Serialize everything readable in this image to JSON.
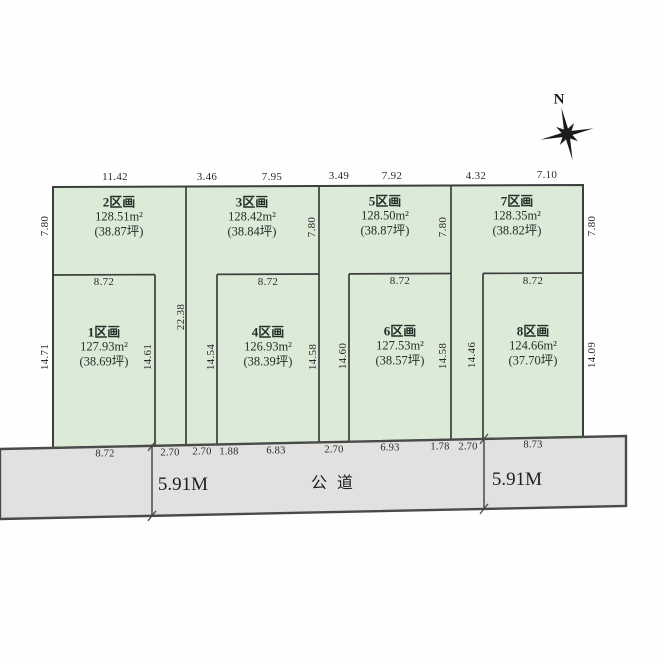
{
  "compass": {
    "north_label": "N"
  },
  "top_dims": [
    "11.42",
    "3.46",
    "7.95",
    "3.49",
    "7.92",
    "4.32",
    "7.10"
  ],
  "parcels": {
    "p1": {
      "name": "1区画",
      "area": "127.93m²",
      "tsubo": "(38.69坪)",
      "width": "8.72"
    },
    "p2": {
      "name": "2区画",
      "area": "128.51m²",
      "tsubo": "(38.87坪)"
    },
    "p3": {
      "name": "3区画",
      "area": "128.42m²",
      "tsubo": "(38.84坪)"
    },
    "p4": {
      "name": "4区画",
      "area": "126.93m²",
      "tsubo": "(38.39坪)",
      "width": "8.72"
    },
    "p5": {
      "name": "5区画",
      "area": "128.50m²",
      "tsubo": "(38.87坪)"
    },
    "p6": {
      "name": "6区画",
      "area": "127.53m²",
      "tsubo": "(38.57坪)",
      "width": "8.72"
    },
    "p7": {
      "name": "7区画",
      "area": "128.35m²",
      "tsubo": "(38.82坪)"
    },
    "p8": {
      "name": "8区画",
      "area": "124.66m²",
      "tsubo": "(37.70坪)",
      "width": "8.72"
    }
  },
  "side_dims": {
    "left_top": "7.80",
    "p3_right_top": "7.80",
    "p5_right_top": "7.80",
    "right_top": "7.80",
    "left_bottom": "14.71",
    "p1_right": "14.61",
    "pole_23": "22.38",
    "p4_left": "14.54",
    "p4_right": "14.58",
    "p6_left": "14.60",
    "p6_right": "14.58",
    "p8_left": "14.46",
    "right_bottom": "14.09"
  },
  "frontage_dims": [
    "8.72",
    "2.70",
    "2.70",
    "1.88",
    "6.83",
    "2.70",
    "6.93",
    "1.78",
    "2.70",
    "8.73"
  ],
  "road": {
    "label": "公道",
    "width_left": "5.91M",
    "width_right": "5.91M"
  },
  "colors": {
    "parcel_fill": "#dcead8",
    "road_fill": "#e1e1e0",
    "line": "#3c3f3d",
    "road_line": "#4a4a4a"
  }
}
